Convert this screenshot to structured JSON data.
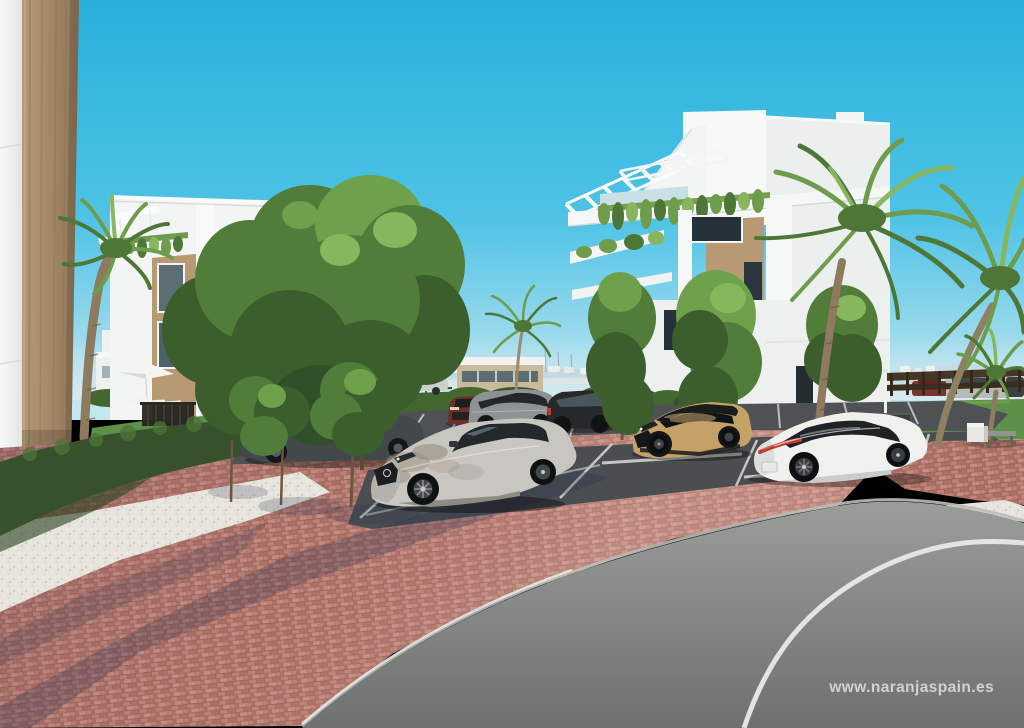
{
  "meta": {
    "domain": "natural-image",
    "description": "3D architectural rendering of a modern white apartment complex with palm trees, landscaped hedges, a brick-paved parking area and a curved asphalt road under a clear cyan sky."
  },
  "watermark": {
    "text": "www.naranjaspain.es"
  },
  "scene": {
    "left_building": "white modern apartment block with tan stone accents, roof canopies and hanging plants",
    "right_building": "white four-storey apartment block with rooftop louvre pergolas, planted balconies and timber wall panels",
    "foreground_left": "close-up building corner: white wall and tan rammed-earth pillar",
    "vegetation": [
      "canary palms",
      "young deciduous trees",
      "large green tree",
      "boxwood hedges",
      "lawn strips"
    ],
    "vehicles": [
      {
        "name": "silver suv",
        "position": "front center, parked"
      },
      {
        "name": "tan compact suv with black roof",
        "position": "center right, parked"
      },
      {
        "name": "white coupe sedan",
        "position": "right, parked"
      },
      {
        "name": "dark gray sedan",
        "position": "left, behind young trees"
      },
      {
        "name": "dark red suv",
        "position": "background row"
      },
      {
        "name": "gray suv",
        "position": "background row"
      },
      {
        "name": "black suv",
        "position": "background row"
      },
      {
        "name": "distant cars",
        "position": "behind wooden fence, right"
      }
    ],
    "ground": [
      "red clay brick paving",
      "dark asphalt parking bays with white markings",
      "white gravel beds",
      "curved gray asphalt road with white lane line"
    ],
    "background": "hazy coastline with distant boats, masts and low hills",
    "furniture": [
      "white parasol",
      "sun loungers",
      "dark pool fence",
      "concrete bench",
      "white lamp post"
    ]
  },
  "colors": {
    "sky_top": "#27b0d9",
    "sky_mid": "#4fc3e6",
    "sky_horizon": "#c3e6ef",
    "haze": "#c6d9e2",
    "white_wall": "#f2f5f4",
    "wall_shade": "#e3e8e7",
    "wall_dark": "#d5dcda",
    "tan_wall": "#b79a73",
    "tan_column": "#a88e6c",
    "window_dark": "#26323a",
    "glass_light": "#c9dfe6",
    "fence_dark": "#24211c",
    "fence_brown": "#463626",
    "hedge_dark": "#36512b",
    "hedge_mid": "#44662f",
    "hedge_light": "#57803c",
    "grass": "#5f9049",
    "grass_light": "#6fa254",
    "tree_dark": "#3c5e2d",
    "tree_mid": "#527c3a",
    "tree_light": "#6fa04c",
    "tree_pale": "#86b75d",
    "palm_mid": "#6f9c4c",
    "palm_dark": "#4e7637",
    "palm_light": "#8ab55f",
    "trunk": "#8d7a5f",
    "trunk_dark": "#6b5440",
    "brick_a": "#bd8177",
    "brick_b": "#ac6f66",
    "brick_c": "#c68c81",
    "brick_mortar": "#9a6158",
    "gravel": "#e6e4dc",
    "asphalt_park": "#4e5254",
    "road_light": "#a0a3a0",
    "road_dark": "#6e716f",
    "line_white": "#e7eae6",
    "shadow_blue": "#273052",
    "car_silver": "#c8c6c1",
    "car_white": "#f0f1ee",
    "car_tan": "#c4a166",
    "car_gray": "#8d9294",
    "car_darkgray": "#43484b",
    "car_black": "#26282a",
    "car_red": "#722d2a",
    "taillight": "#c23a33",
    "watermark": "#f0f2f0"
  }
}
